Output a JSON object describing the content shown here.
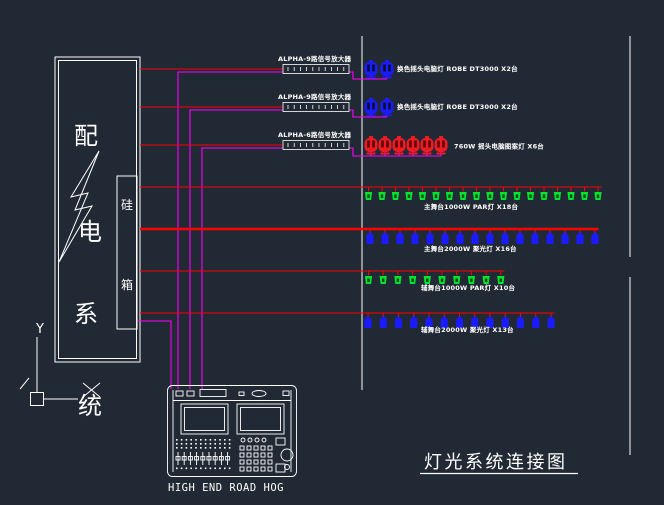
{
  "colors": {
    "background": "#212a34",
    "wire_red": "#ff0000",
    "wire_magenta": "#ff00ff",
    "line_white": "#ffffff",
    "fixture_blue": "#1b1bff",
    "fixture_green": "#00e42e",
    "fixture_red": "#ed1c24"
  },
  "title": "灯光系统连接图",
  "distribution_box": {
    "vertical_label": [
      "配",
      "电",
      "系",
      "统"
    ],
    "dimmer_box_label": [
      "硅",
      "箱"
    ]
  },
  "ucs": {
    "axis_label": "Y"
  },
  "console": {
    "brand_label": "HIGH END  ROAD HOG"
  },
  "amplifiers": [
    {
      "label": "ALPHA-9路信号放大器"
    },
    {
      "label": "ALPHA-9路信号放大器"
    },
    {
      "label": "ALPHA-6路信号放大器"
    }
  ],
  "fixture_rows": [
    {
      "label": "换色摇头电脑灯 ROBE DT3000 X2台",
      "count": 2,
      "fixture": "moving-head",
      "color_key": "fixture_blue"
    },
    {
      "label": "换色摇头电脑灯 ROBE DT3000 X2台",
      "count": 2,
      "fixture": "moving-head",
      "color_key": "fixture_blue"
    },
    {
      "label": "760W  摇头电脑图案灯  X6台",
      "count": 6,
      "fixture": "moving-head",
      "color_key": "fixture_red"
    },
    {
      "label": "主舞台1000W PAR灯  X18台",
      "count": 18,
      "fixture": "par-can",
      "color_key": "fixture_green"
    },
    {
      "label": "主舞台2000W 聚光灯  X16台",
      "count": 16,
      "fixture": "spot-light",
      "color_key": "fixture_blue"
    },
    {
      "label": "辅舞台1000W PAR灯  X10台",
      "count": 10,
      "fixture": "par-can",
      "color_key": "fixture_green"
    },
    {
      "label": "辅舞台2000W 聚光灯  X13台",
      "count": 13,
      "fixture": "spot-light",
      "color_key": "fixture_blue"
    }
  ]
}
